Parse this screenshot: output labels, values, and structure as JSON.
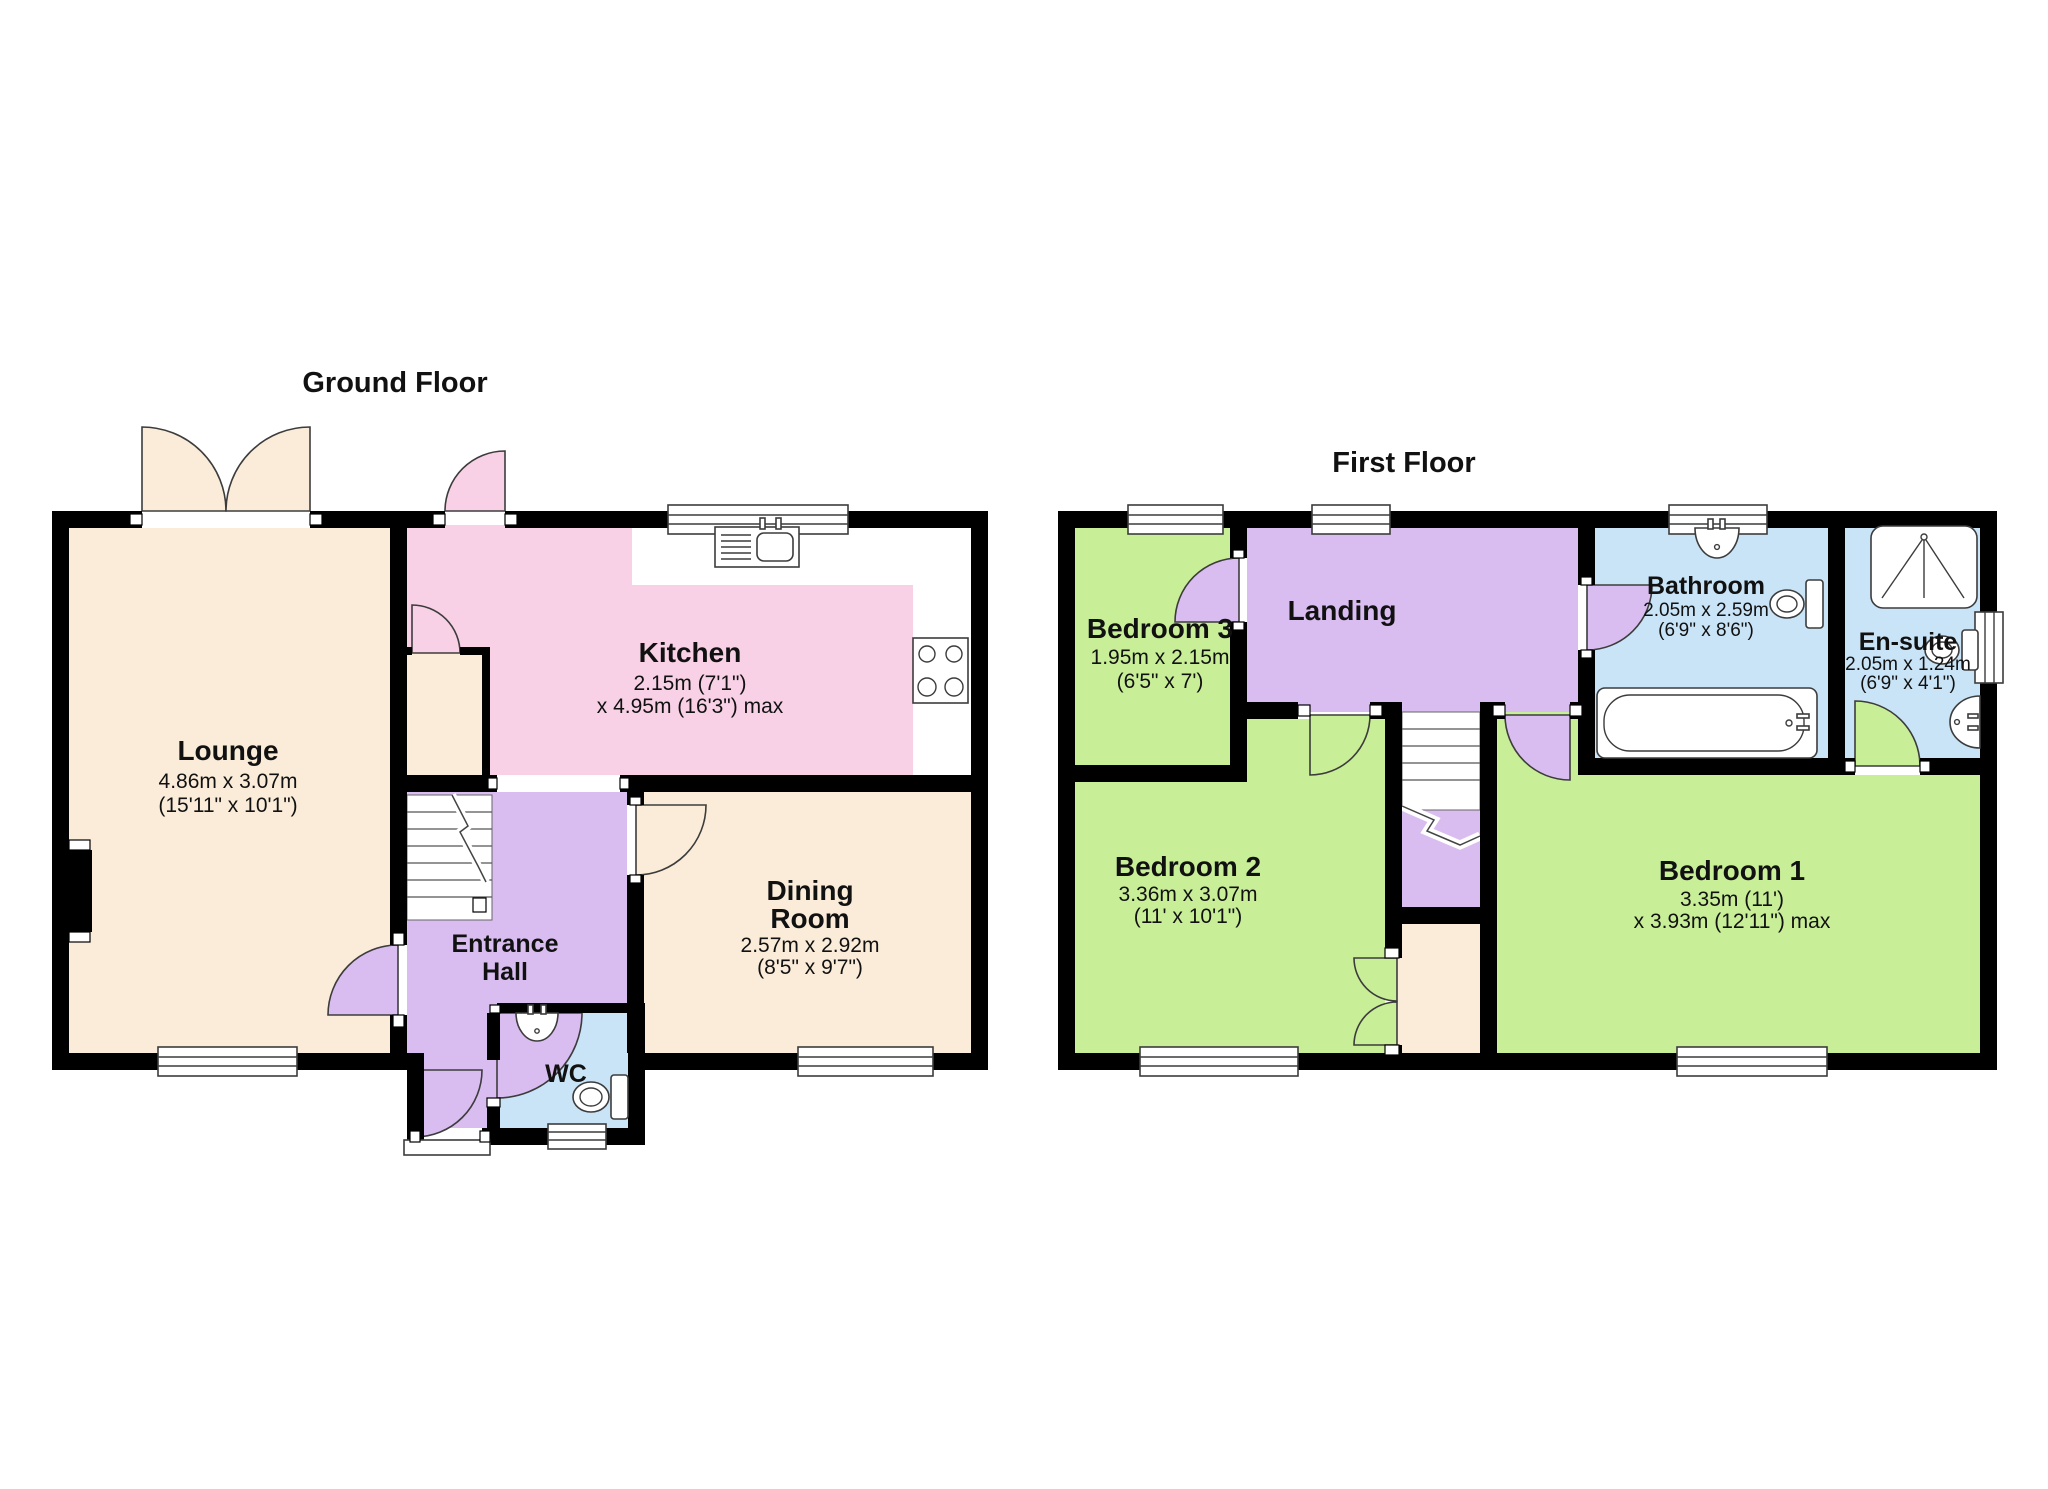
{
  "colors": {
    "wall": "#000000",
    "cream": "#FAECD9",
    "pink": "#F8D1E6",
    "purple": "#DABDF0",
    "green": "#C9EE98",
    "blue": "#CAE4F7",
    "text": "#111111"
  },
  "ground_floor": {
    "title": "Ground Floor",
    "lounge": {
      "name": "Lounge",
      "dims1": "4.86m x 3.07m",
      "dims2": "(15'11\" x 10'1\")"
    },
    "kitchen": {
      "name": "Kitchen",
      "dims1": "2.15m (7'1\")",
      "dims2": "x 4.95m (16'3\") max"
    },
    "dining": {
      "name1": "Dining",
      "name2": "Room",
      "dims1": "2.57m x 2.92m",
      "dims2": "(8'5\" x 9'7\")"
    },
    "hall": {
      "name1": "Entrance",
      "name2": "Hall"
    },
    "wc": {
      "name": "WC"
    }
  },
  "first_floor": {
    "title": "First Floor",
    "bedroom3": {
      "name": "Bedroom 3",
      "dims1": "1.95m x 2.15m",
      "dims2": "(6'5\" x 7')"
    },
    "landing": {
      "name": "Landing"
    },
    "bathroom": {
      "name": "Bathroom",
      "dims1": "2.05m x 2.59m",
      "dims2": "(6'9\" x 8'6\")"
    },
    "ensuite": {
      "name": "En-suite",
      "dims1": "2.05m x 1.24m",
      "dims2": "(6'9\" x 4'1\")"
    },
    "bedroom2": {
      "name": "Bedroom 2",
      "dims1": "3.36m x 3.07m",
      "dims2": "(11' x 10'1\")"
    },
    "bedroom1": {
      "name": "Bedroom 1",
      "dims1": "3.35m (11')",
      "dims2": "x 3.93m (12'11\") max"
    }
  }
}
